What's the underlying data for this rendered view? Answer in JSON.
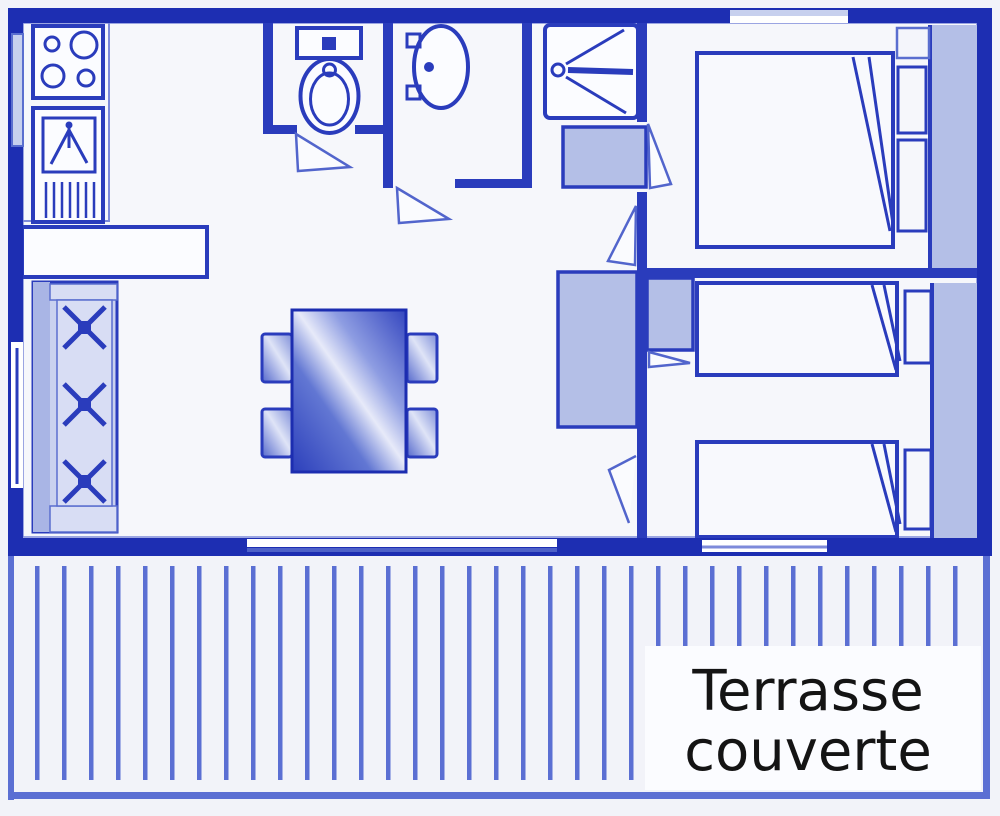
{
  "document": {
    "kind": "floor-plan",
    "style": "blueprint-line-drawing",
    "subject": "mobile-home / bungalow plan with covered terrace"
  },
  "terrace_label": {
    "line1": "Terrasse",
    "line2": "couverte"
  },
  "legend": {
    "rooms": [
      "kitchen",
      "living-dining-room",
      "wc",
      "washbasin-room",
      "shower-room",
      "bedroom-1",
      "bedroom-2",
      "covered-terrace"
    ],
    "fixtures": [
      "stove-4-burners",
      "kitchen-sink-with-drainer",
      "bar-counter",
      "bench-sofa-3-seats",
      "dining-table",
      "four-chairs",
      "toilet",
      "washbasin",
      "shower",
      "water-heater",
      "double-bed",
      "two-single-beds",
      "pillows",
      "wardrobes",
      "door-leaves",
      "windows",
      "deck-boards"
    ]
  },
  "colors": {
    "paper": "#f2f3f9",
    "floor": "#f6f7fb",
    "wall": "#1d2eb2",
    "wall2": "#2a3cbc",
    "outline": "#2c40bd",
    "thin": "#7d8ada",
    "glaze": "#c7d0ee",
    "fillLight": "#b4bfe7",
    "benchFill": "#c9d1ef",
    "benchSeat": "#d8ddf4",
    "deck": "#5b6fd3",
    "white": "#fbfcff",
    "ink": "#141414"
  }
}
